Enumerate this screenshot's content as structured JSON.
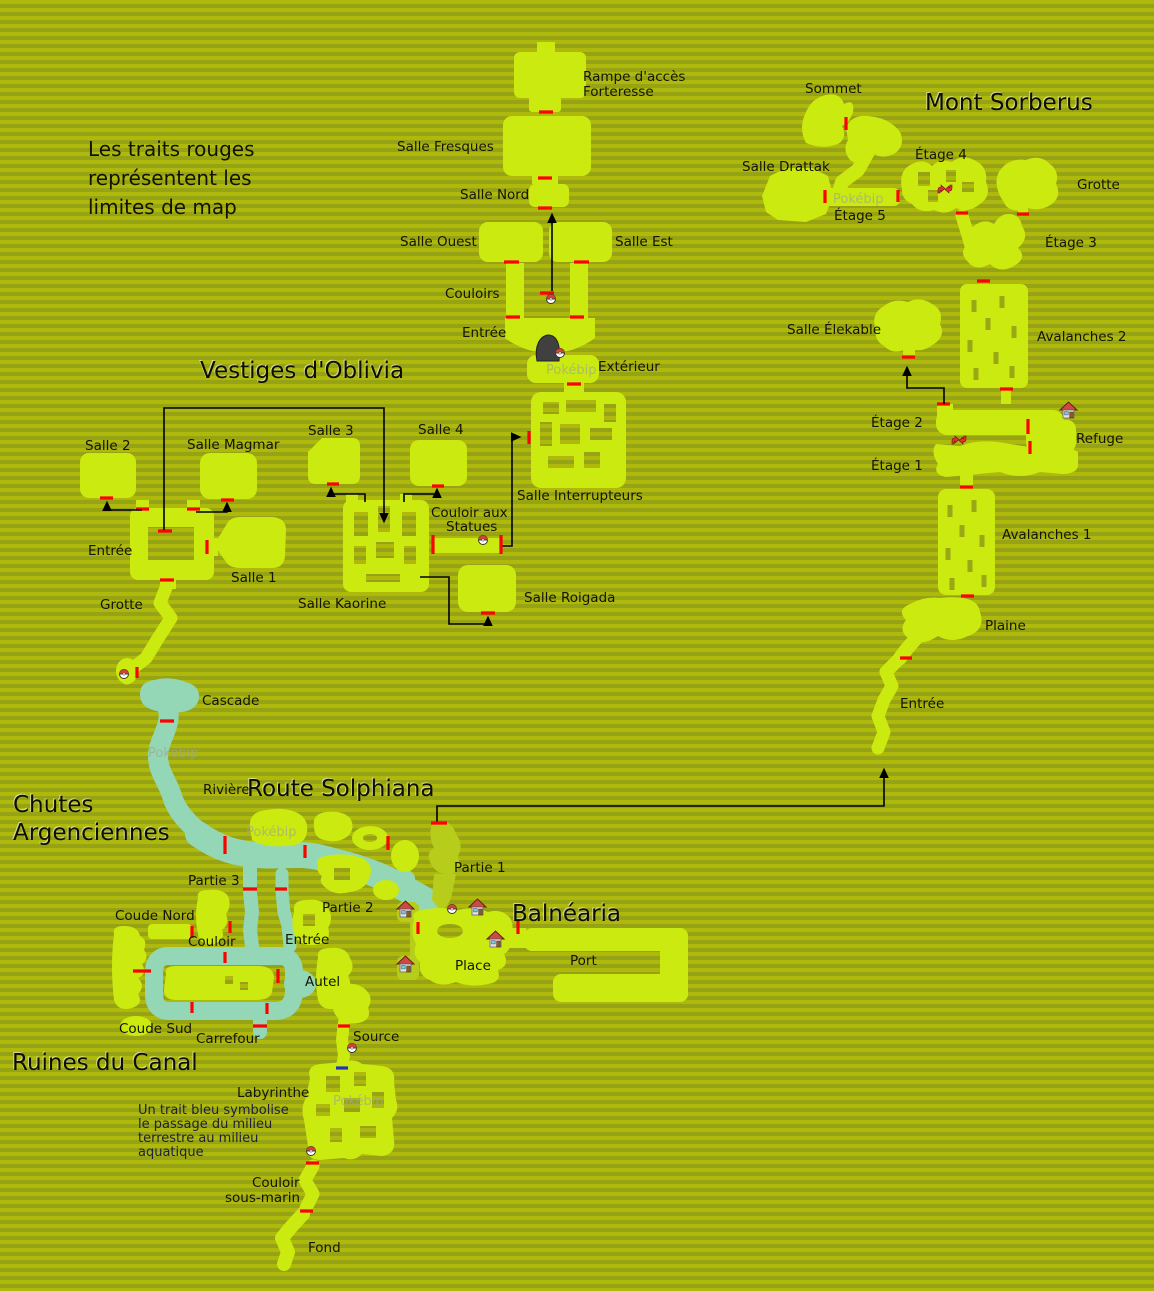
{
  "colors": {
    "background_stripe_light": "#aeb90c",
    "background_stripe_dark": "#95a315",
    "map_green": "#cbea10",
    "bank_green": "#b6ce1b",
    "water_teal": "#94d7b6",
    "boundary_red": "#ff0000",
    "passage_blue": "#2233bb"
  },
  "notes": {
    "red_lines": [
      "Les traits rouges",
      "représentent les",
      "limites de map"
    ],
    "blue_lines": [
      "Un trait bleu symbolise",
      "le passage du milieu",
      "terrestre au milieu",
      "aquatique"
    ]
  },
  "watermark": "Pokébip",
  "titles": {
    "vestiges": "Vestiges d'Oblivia",
    "sorberus": "Mont Sorberus",
    "chutes_1": "Chutes",
    "chutes_2": "Argenciennes",
    "route": "Route Solphiana",
    "balnearia": "Balnéaria",
    "ruines": "Ruines du Canal"
  },
  "forteresse": {
    "rampe_1": "Rampe d'accès",
    "rampe_2": "Forteresse",
    "salle_fresques": "Salle Fresques",
    "salle_nord": "Salle Nord",
    "salle_ouest": "Salle Ouest",
    "salle_est": "Salle Est",
    "couloirs": "Couloirs",
    "entree": "Entrée",
    "exterieur": "Extérieur",
    "salle_interrupteurs": "Salle Interrupteurs"
  },
  "vestiges": {
    "salle_2": "Salle 2",
    "salle_magmar": "Salle Magmar",
    "salle_3": "Salle 3",
    "salle_4": "Salle 4",
    "entree": "Entrée",
    "salle_1": "Salle 1",
    "grotte": "Grotte",
    "salle_kaorine": "Salle Kaorine",
    "couloir_statues_1": "Couloir aux",
    "couloir_statues_2": "Statues",
    "salle_roigada": "Salle Roigada"
  },
  "sorberus": {
    "sommet": "Sommet",
    "salle_drattak": "Salle Drattak",
    "etage_4": "Étage 4",
    "grotte": "Grotte",
    "etage_5": "Étage 5",
    "etage_3": "Étage 3",
    "avalanches_2": "Avalanches 2",
    "salle_elekable": "Salle Élekable",
    "etage_2": "Étage 2",
    "refuge": "Refuge",
    "etage_1": "Étage 1",
    "avalanches_1": "Avalanches 1",
    "plaine": "Plaine",
    "entree": "Entrée"
  },
  "chutes": {
    "cascade": "Cascade",
    "riviere": "Rivière"
  },
  "route": {
    "partie_3": "Partie 3",
    "partie_2": "Partie 2",
    "partie_1": "Partie 1"
  },
  "balnearia": {
    "place": "Place",
    "port": "Port"
  },
  "ruines": {
    "coude_nord": "Coude Nord",
    "couloir": "Couloir",
    "entree": "Entrée",
    "autel": "Autel",
    "coude_sud": "Coude Sud",
    "carrefour": "Carrefour",
    "source": "Source",
    "labyrinthe": "Labyrinthe",
    "couloir_sm_1": "Couloir",
    "couloir_sm_2": "sous-marin",
    "fond": "Fond"
  }
}
